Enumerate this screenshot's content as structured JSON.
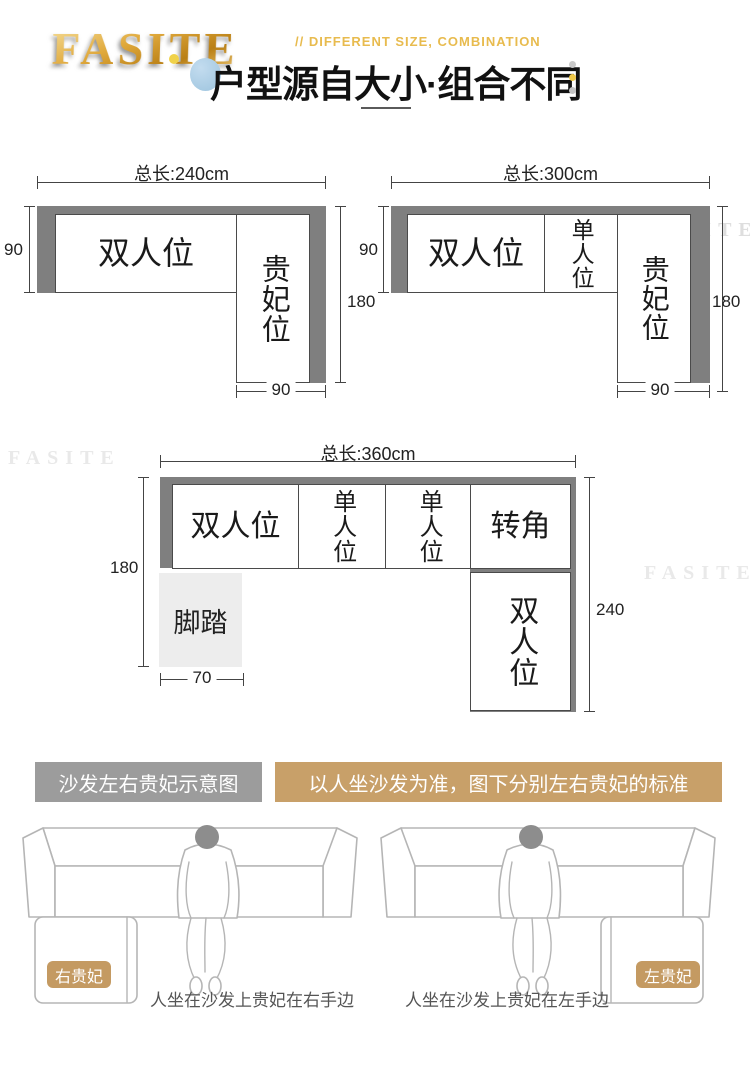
{
  "header": {
    "logo": "FASITE",
    "subtitle": "// DIFFERENT SIZE, COMBINATION",
    "title": "户型源自大小·组合不同"
  },
  "brand": {
    "watermark": "FASITE"
  },
  "diagrams": [
    {
      "total_label": "总长:240cm",
      "left_dim": "90",
      "right_dim": "180",
      "bottom_dim": "90",
      "sections": [
        {
          "label": "双人位"
        },
        {
          "label": "贵妃位"
        }
      ]
    },
    {
      "total_label": "总长:300cm",
      "left_dim": "90",
      "right_dim": "180",
      "bottom_dim": "90",
      "sections": [
        {
          "label": "双人位"
        },
        {
          "label": "单人位"
        },
        {
          "label": "贵妃位"
        }
      ]
    },
    {
      "total_label": "总长:360cm",
      "left_dim": "180",
      "right_dim": "240",
      "bottom_dim": "70",
      "sections": [
        {
          "label": "双人位"
        },
        {
          "label": "单人位"
        },
        {
          "label": "单人位"
        },
        {
          "label": "转角"
        },
        {
          "label": "双人位"
        },
        {
          "label": "脚踏"
        }
      ]
    }
  ],
  "legend": {
    "left_label": "沙发左右贵妃示意图",
    "right_label": "以人坐沙发为准，图下分别左右贵妃的标准"
  },
  "illustrations": [
    {
      "badge": "右贵妃",
      "caption": "人坐在沙发上贵妃在右手边"
    },
    {
      "badge": "左贵妃",
      "caption": "人坐在沙发上贵妃在左手边"
    }
  ],
  "colors": {
    "sofa_band_gray": "#7f7f7f",
    "banner_gray": "#9c9c9c",
    "banner_tan": "#c8a069",
    "badge_tan": "#c49a62",
    "accent_gold": "#e8bb4e",
    "accent_blue": "#a9cbe2",
    "footstool_gray": "#ededed"
  }
}
